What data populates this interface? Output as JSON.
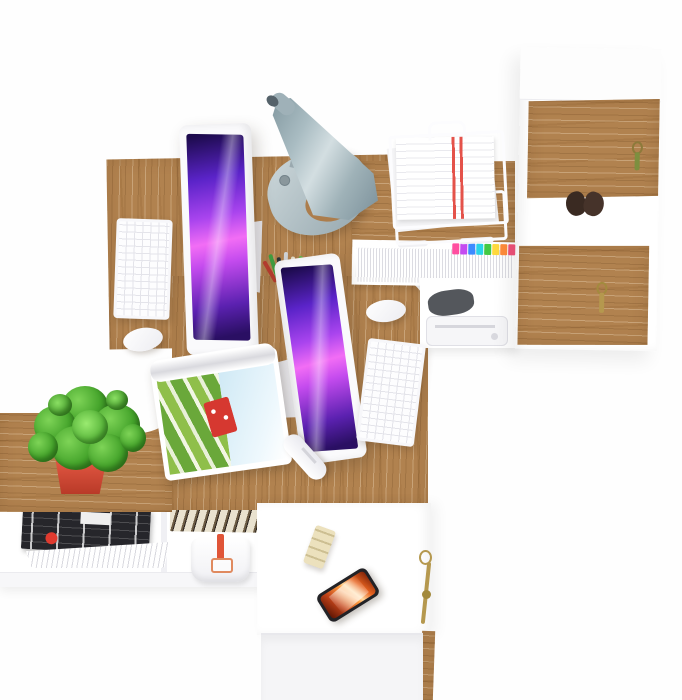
{
  "scene": {
    "title": "Top-down view of a white and oak office workspace with two computer workstations",
    "background_color": "#fefefe"
  },
  "labels": {
    "scene": "Top-down view of a white and oak office workspace",
    "desk1": "Oak desktop of workstation one",
    "desk_return": "Oak desk return",
    "desk2": "Oak desktop of workstation two",
    "sideboard": "Oak sideboard top",
    "desk_gap": "Curved white gap between desks",
    "plant": "Green potted plant in red planter",
    "lamp": "Grey cone desk lamp",
    "imac1": "All-in-one computer with purple wallpaper, workstation one",
    "imac2": "All-in-one computer with purple wallpaper, workstation two",
    "keyboard1": "White wireless keyboard, workstation one",
    "keyboard2": "White wireless keyboard, workstation two",
    "mouse1": "White mouse, workstation one",
    "mouse2": "White mouse, workstation two",
    "pencup": "Mesh pen cup with pens and pencils",
    "tray": "White wire paper tray with documents",
    "document_red": "Document with red stripes",
    "cabinet": "Tall white cabinet with oak doors",
    "cabinet_door_upper": "Upper oak cabinet door with green-tassel key",
    "cabinet_door_lower": "Lower oak cabinet door with gold-tassel key",
    "gloves": "Dark gloves hanging on cabinet shelf",
    "files": "Filed papers with colored index tabs",
    "dark_item": "Dark pouch on under-desk shelf",
    "printer": "Compact white printer on under-desk shelf",
    "magazine": "Open magazine with red barn landscape photo",
    "bottle": "White capsule-shaped bottle",
    "shelf": "Low white shelf unit",
    "magazines": "Stack of magazines",
    "papers_fan": "Fanned white papers",
    "books": "Row of books seen from above",
    "bag": "White lunch bag with red strap",
    "bottom_desk": "White drawer cabinet desk",
    "drawer": "White drawer front",
    "phone": "Smartphone with fiery orange wallpaper",
    "snack_bar": "Cream snack bar",
    "key_gold": "Brass key with tassel"
  },
  "colors": {
    "wood": "#b1824f",
    "wood_light": "#c99e6f",
    "wood_dark": "#8a6136",
    "white_furniture": "#ffffff",
    "lamp_gray": "#9fb3ba",
    "screen_purple": "#8a2be2",
    "screen_pink": "#f26df5",
    "pot_red": "#d84a35",
    "plant_green": "#46a52c",
    "phone_fire_orange": "#ff9e40",
    "strap_red": "#e05538",
    "tassel_green": "#7d8f3f",
    "tassel_gold": "#b5984e",
    "tab_colors": [
      "#ff4fa0",
      "#c44bf0",
      "#3d8bff",
      "#2ad4e8",
      "#43c943",
      "#ffd93d",
      "#ff8c3a",
      "#f0527a"
    ],
    "pen_colors": [
      "#b23b2e",
      "#3f9b3f",
      "#2d3436",
      "#cfd3d6",
      "#e8e0cc",
      "#6ab04c",
      "#8a6a4a"
    ]
  }
}
